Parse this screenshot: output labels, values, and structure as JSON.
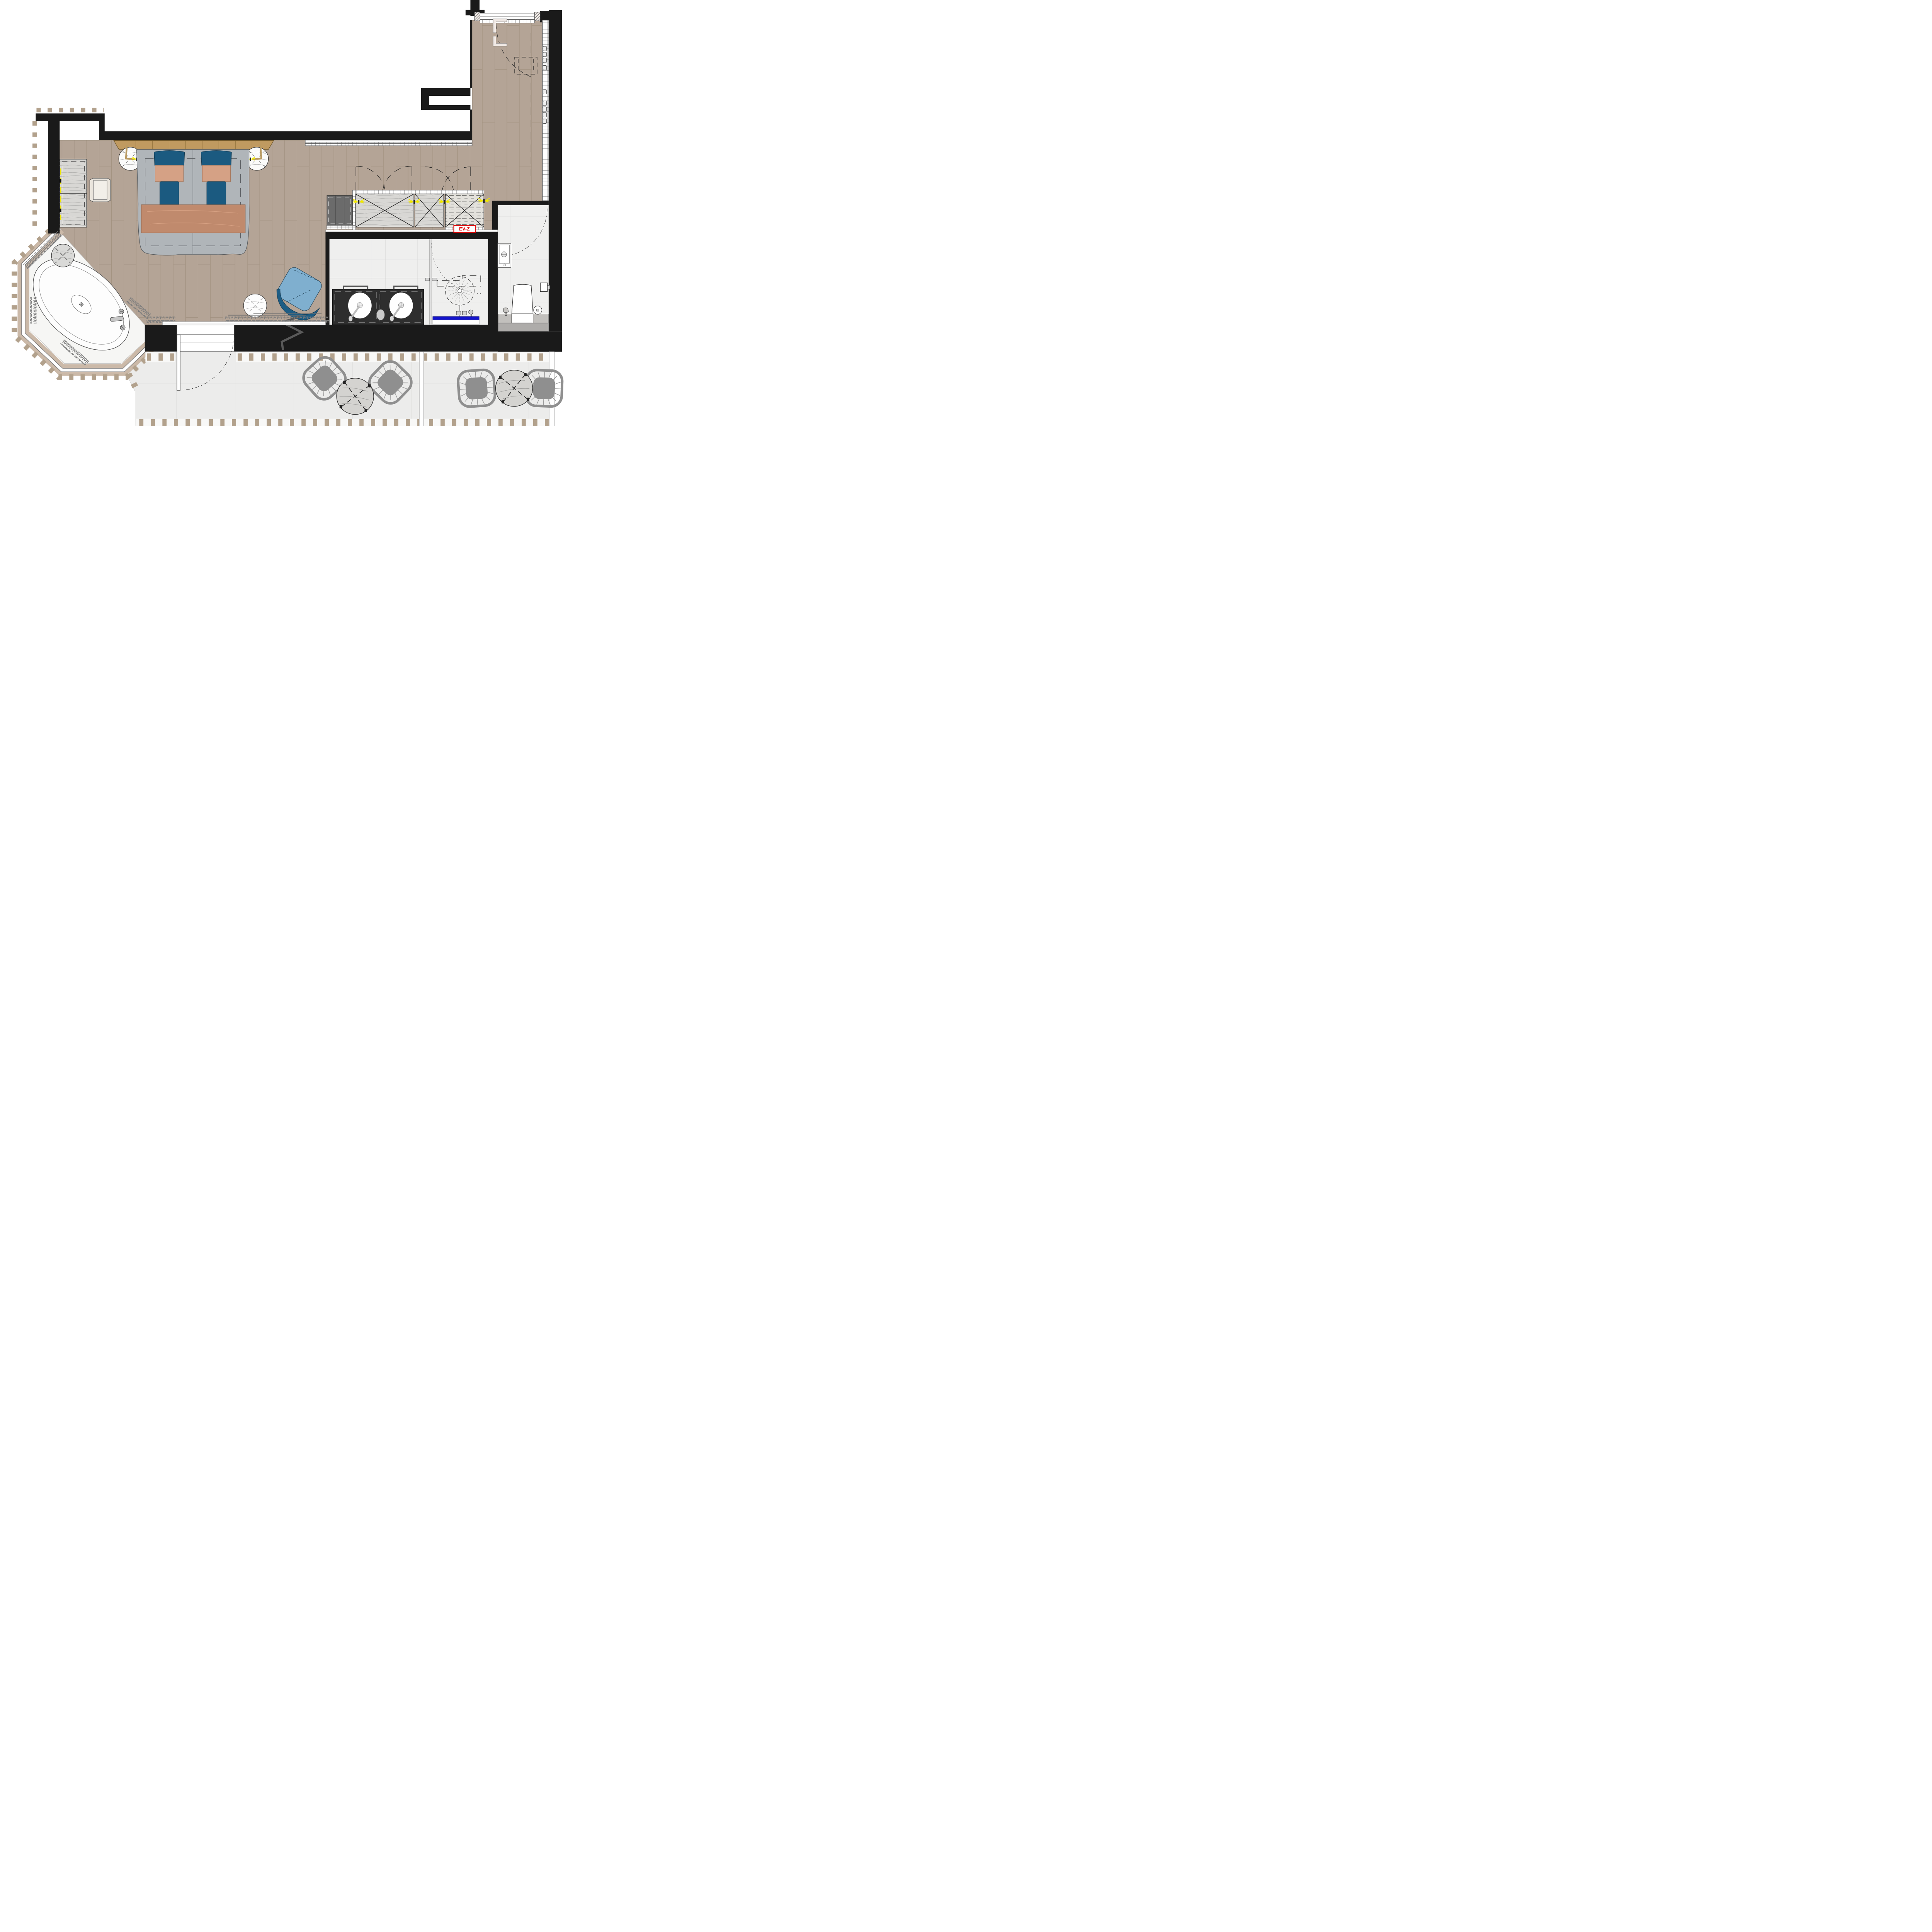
{
  "document": {
    "type": "architectural floor plan",
    "description": "Hotel suite plan: bedroom with double bed, dressing corridor with wardrobes, bathroom with double vanity and rain shower, WC room, octagonal whirlpool bay with oval tub, and terrace with lounge furniture"
  },
  "labels": {
    "unit_tag": "EV-Z"
  },
  "rooms": [
    {
      "name": "bedroom"
    },
    {
      "name": "dressing-corridor"
    },
    {
      "name": "entry-hall"
    },
    {
      "name": "bathroom"
    },
    {
      "name": "shower"
    },
    {
      "name": "wc"
    },
    {
      "name": "whirlpool-bay"
    },
    {
      "name": "terrace"
    }
  ],
  "furniture": [
    "double-bed-with-copper-throw",
    "headboard",
    "nightstand-left",
    "nightstand-right",
    "dresser",
    "ottoman-stool",
    "lounge-chair-blue",
    "side-table-round",
    "wardrobe-units",
    "minibar-cabinet",
    "vanity-two-basins",
    "towel-bars",
    "rain-shower-head",
    "shower-bench",
    "wall-basin",
    "toilet",
    "toilet-paper-holder",
    "oval-bathtub",
    "tub-side-table",
    "tub-faucet",
    "terrace-wire-chairs",
    "terrace-oval-tables",
    "luggage-rack"
  ],
  "colors": {
    "wall": "#1a1a1a",
    "wood": "#b4a496",
    "woodline": "#a austere",
    "plankline": "#a29280",
    "bath": "#efefee",
    "tile": "#d9d9d8",
    "terrace": "#ececeb",
    "bay": "#f6f6f4",
    "band": "#cbb9a8",
    "baluster": "#b2a18c",
    "curtain": "#7d7d7d",
    "bluechair": "#7fafcf",
    "bluedark": "#1e5d84",
    "pillow": "#1b5a80",
    "copper": "#c08a6d",
    "copperlight": "#d5a185",
    "duvet": "#b0b5b9",
    "headboard": "#c09a60",
    "counter": "#2e2e2e",
    "gray": "#8f8f8f",
    "closet": "#d8d7d4",
    "closetdash": "#e3e1dc",
    "darkunit": "#6b6b6b",
    "accent_red": "#e00000",
    "drain_blue": "#1414cc",
    "hinge_yellow": "#f0e800",
    "stool": "#eae5dd",
    "tabletop": "#d4d3d0",
    "white": "#ffffff"
  }
}
